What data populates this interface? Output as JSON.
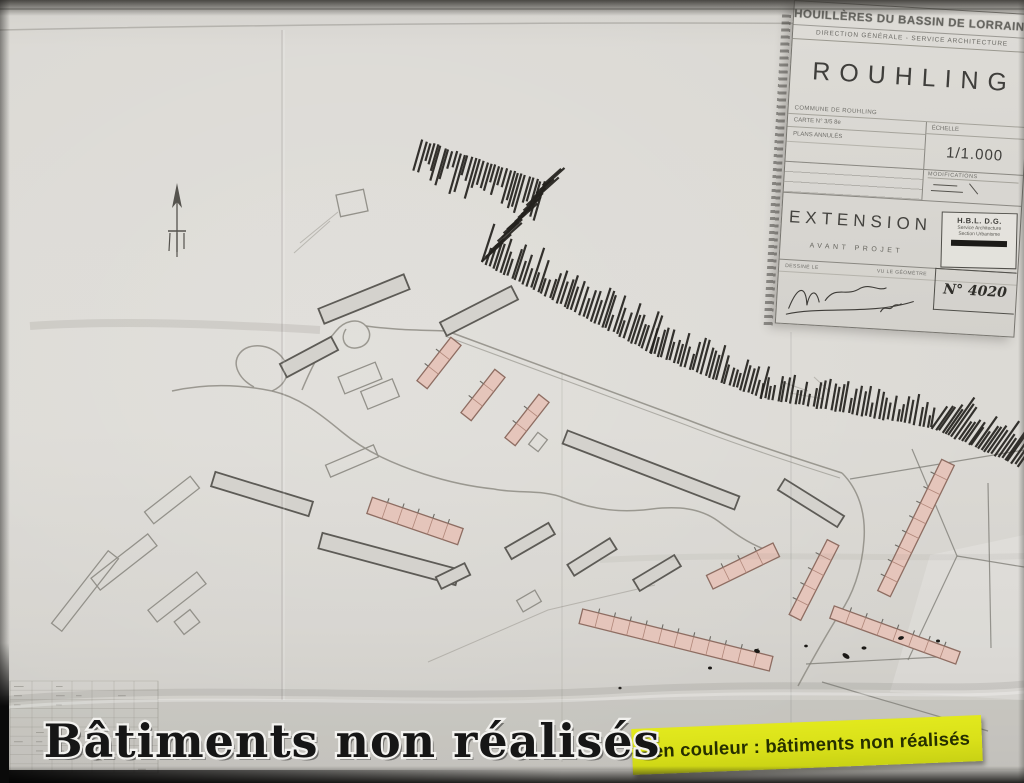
{
  "frame": {
    "caption": "Bâtiments non réalisés"
  },
  "legend": {
    "text": "- en couleur : bâtiments non réalisés"
  },
  "title_block": {
    "org_line1": "HOUILLÈRES DU BASSIN DE LORRAINE",
    "org_line2": "DIRECTION GÉNÉRALE - SERVICE ARCHITECTURE",
    "city": "ROUHLING",
    "row_commune": "COMMUNE DE ROUHLING",
    "row_carte": "CARTE N° 3/5 8e",
    "row_plans": "PLANS ANNULÉS",
    "label_echelle": "ÉCHELLE",
    "scale": "1/1.000",
    "label_modifications": "MODIFICATIONS",
    "title": "EXTENSION",
    "subtitle": "AVANT PROJET",
    "row_dessine": "DESSINÉ LE",
    "row_geometre": "VU LE GÉOMÈTRE",
    "stamp_org": "H.B.L. D.G.",
    "stamp_line1": "Service Architecture",
    "stamp_line2": "Section Urbanisme",
    "doc_number": "N° 4020"
  },
  "theme": {
    "paper": "#d9d7d2",
    "ink": "#24221e",
    "road": "#8e8c84",
    "gray_stroke": "#5d5b56",
    "gray_fill": "#d4d2cd",
    "light_stroke": "#93918a",
    "pink": "#e5c5bb",
    "pink_stroke": "#8e6d62",
    "pink_div": "#b08679",
    "yellow": "#d9e019",
    "yellow_text": "#262f00",
    "caption_fill": "#161616",
    "caption_stroke": "#f3f2ef",
    "blob": "#1b1916"
  },
  "map": {
    "buildings": [
      [
        172,
        500,
        58,
        15,
        -38,
        "light"
      ],
      [
        124,
        562,
        72,
        15,
        -38,
        "light"
      ],
      [
        177,
        597,
        62,
        15,
        -38,
        "light"
      ],
      [
        187,
        622,
        20,
        16,
        -38,
        "light"
      ],
      [
        85,
        591,
        92,
        13,
        -52,
        "light"
      ],
      [
        352,
        461,
        52,
        13,
        -23,
        "light"
      ],
      [
        529,
        601,
        21,
        13,
        -30,
        "light"
      ],
      [
        538,
        442,
        15,
        12,
        -52,
        "light"
      ],
      [
        352,
        203,
        28,
        22,
        -12,
        "light"
      ],
      [
        360,
        378,
        40,
        18,
        -22,
        "light"
      ],
      [
        380,
        394,
        34,
        19,
        -22,
        "light"
      ],
      [
        262,
        494,
        102,
        15,
        17,
        "gray"
      ],
      [
        389,
        559,
        142,
        16,
        15,
        "gray"
      ],
      [
        364,
        299,
        92,
        16,
        -22,
        "gray"
      ],
      [
        309,
        357,
        58,
        15,
        -28,
        "gray"
      ],
      [
        479,
        311,
        80,
        15,
        -27,
        "gray"
      ],
      [
        651,
        470,
        184,
        14,
        21,
        "gray"
      ],
      [
        530,
        541,
        50,
        13,
        -30,
        "gray"
      ],
      [
        592,
        557,
        50,
        13,
        -32,
        "gray"
      ],
      [
        657,
        573,
        48,
        13,
        -31,
        "gray"
      ],
      [
        453,
        576,
        32,
        13,
        -26,
        "gray"
      ],
      [
        811,
        503,
        70,
        13,
        32,
        "gray"
      ],
      [
        439,
        363,
        55,
        13,
        -52,
        "pink"
      ],
      [
        483,
        395,
        55,
        13,
        -52,
        "pink"
      ],
      [
        527,
        420,
        55,
        13,
        -52,
        "pink"
      ],
      [
        415,
        521,
        96,
        17,
        19,
        "pink"
      ],
      [
        743,
        566,
        74,
        15,
        -26,
        "pink"
      ],
      [
        676,
        640,
        196,
        15,
        14,
        "pink"
      ],
      [
        916,
        528,
        146,
        14,
        -64,
        "pink"
      ],
      [
        814,
        580,
        84,
        13,
        -63,
        "pink"
      ],
      [
        895,
        635,
        134,
        13,
        20,
        "pink"
      ]
    ],
    "hatch": [
      [
        422,
        140,
        545,
        182,
        106,
        4.0,
        16,
        46
      ],
      [
        543,
        186,
        482,
        262,
        -42,
        5.0,
        14,
        38
      ],
      [
        482,
        262,
        650,
        353,
        -72,
        4.2,
        16,
        42
      ],
      [
        650,
        353,
        760,
        398,
        -75,
        4.2,
        14,
        36
      ],
      [
        760,
        398,
        932,
        428,
        -80,
        4.4,
        12,
        32
      ],
      [
        932,
        428,
        1018,
        466,
        -55,
        3.6,
        20,
        46
      ]
    ],
    "roads": [
      "M 172,391 C 212,382 248,386 272,391 C 298,397 318,412 342,432 C 366,452 394,464 424,474 C 452,483 474,487 494,489",
      "M 272,391 C 288,384 292,368 281,356 C 270,344 249,342 240,353 C 231,364 239,379 254,387",
      "M 302,390 C 314,361 324,345 336,331 C 344,321 358,317 366,326 C 374,335 368,347 356,348 C 344,349 340,338 346,329",
      "M 366,326 C 394,330 420,330 447,331",
      "M 447,331 L 688,420 C 724,434 776,452 842,473",
      "M 494,489 C 518,494 542,489 564,498 C 592,510 622,513 652,509 C 678,506 700,508 718,521 C 734,533 748,543 764,549",
      "M 842,473 C 858,489 866,512 864,540 C 862,570 852,596 840,613 C 828,632 812,660 798,686"
    ],
    "roads_thin": [
      "M 445,336 L 686,425 C 722,439 774,457 840,478"
    ],
    "boundaries": [
      "M 850,479 L 1024,450",
      "M 912,449 L 957,556 L 908,660",
      "M 988,483 L 991,648",
      "M 806,664 L 958,656",
      "M 822,682 L 988,731",
      "M 957,556 L 1024,567"
    ],
    "faint": [
      "M 428,662 L 548,610 L 655,585",
      "M 782,382 l 26,9",
      "M 790,393 l 34,6",
      "M 814,377 l 16,15",
      "M 300,243 L 338,212",
      "M 294,253 L 330,221"
    ],
    "blobs": [
      [
        757,
        651,
        3,
        2,
        20
      ],
      [
        710,
        668,
        2,
        1.5,
        0
      ],
      [
        846,
        656,
        4,
        2.2,
        35
      ],
      [
        864,
        648,
        2.5,
        1.6,
        0
      ],
      [
        901,
        638,
        3,
        1.8,
        -15
      ],
      [
        938,
        641,
        2,
        1.5,
        0
      ],
      [
        806,
        646,
        1.8,
        1.4,
        0
      ],
      [
        620,
        688,
        1.6,
        1.3,
        0
      ]
    ],
    "table": {
      "x": 10,
      "y": 681,
      "w": 148,
      "h": 92,
      "cols": [
        0,
        22,
        42,
        62,
        82,
        104,
        124,
        148
      ],
      "rows": 10
    }
  }
}
